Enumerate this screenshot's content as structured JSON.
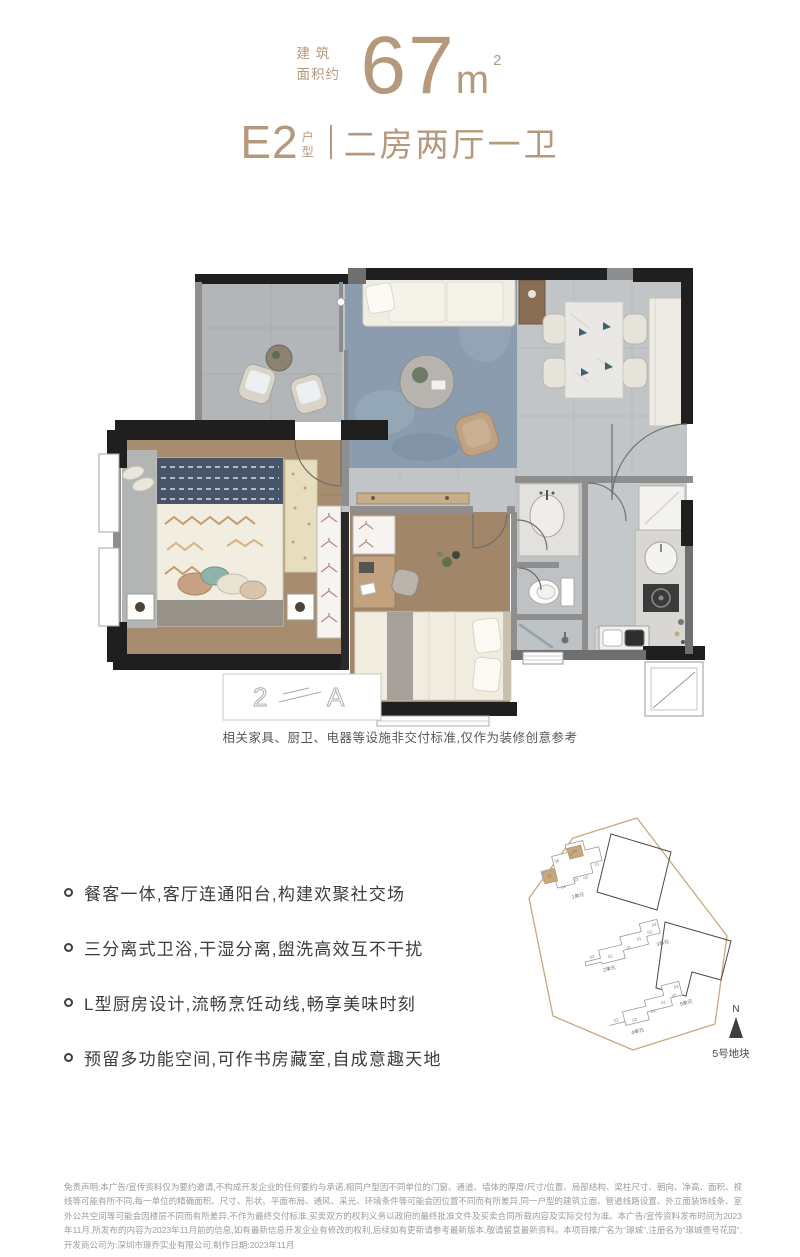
{
  "header": {
    "area_label_line1": "建 筑",
    "area_label_line2": "面积约",
    "area_value": "67",
    "area_unit": "m",
    "area_sup": "2",
    "unit_code": "E2",
    "unit_label_top": "户",
    "unit_label_bottom": "型",
    "layout_name": "二房两厅一卫",
    "accent_color": "#b6987c"
  },
  "floor_plan": {
    "caption": "相关家具、厨卫、电器等设施非交付标准,仅作为装修创意参考",
    "sketch_left": "2",
    "sketch_right": "A"
  },
  "features": [
    "餐客一体,客厅连通阳台,构建欢聚社交场",
    "三分离式卫浴,干湿分离,盥洗高效互不干扰",
    "L型厨房设计,流畅烹饪动线,畅享美味时刻",
    "预留多功能空间,可作书房藏室,自成意趣天地"
  ],
  "site_plan": {
    "plot_label": "5号地块",
    "north_label": "N",
    "buildings": [
      {
        "label": "1单元",
        "units": [
          "06",
          "07",
          "08",
          "01",
          "02",
          "03",
          "04",
          "05"
        ],
        "highlighted_units": [
          "05",
          "08"
        ]
      },
      {
        "label": "2单元",
        "units": [
          "03",
          "02",
          "01"
        ]
      },
      {
        "label": "3单元",
        "units": [
          "01",
          "02",
          "03"
        ]
      },
      {
        "label": "4单元",
        "units": [
          "03",
          "02",
          "01"
        ]
      },
      {
        "label": "5单元",
        "units": [
          "01",
          "02",
          "03"
        ]
      }
    ]
  },
  "disclaimer": "免责声明:本广告/宣传资料仅为要约邀请,不构成开发企业的任何要约与承诺,相同户型因不同单位的门窗、通道、墙体的厚度/尺寸/位置、局部结构、梁柱尺寸、朝向、净高、面积、视线等可能有所不同,每一单位的精确面积、尺寸、形状、平面布局、通风、采光、环境条件等可能会因位置不同而有所差异,同一户型的建筑立面、管道线路设置、外立面装饰线条、室外公共空间等可能会因楼层不同而有所差异,不作为最终交付标准,买卖双方的权利义务以政府的最终批准文件及买卖合同所载内容及实际交付为准。本广告/宣传资料发布时间为2023年11月,所发布的内容为2023年11月前的信息,如有最新信息开发企业有修改的权利,后续如有更新请参考最新版本,敬请留意最新资料。本项目推广名为“璟城”,注册名为“璟城壹号花园”,开发商公司为:深圳市璟乔实业有限公司,制作日期:2023年11月"
}
